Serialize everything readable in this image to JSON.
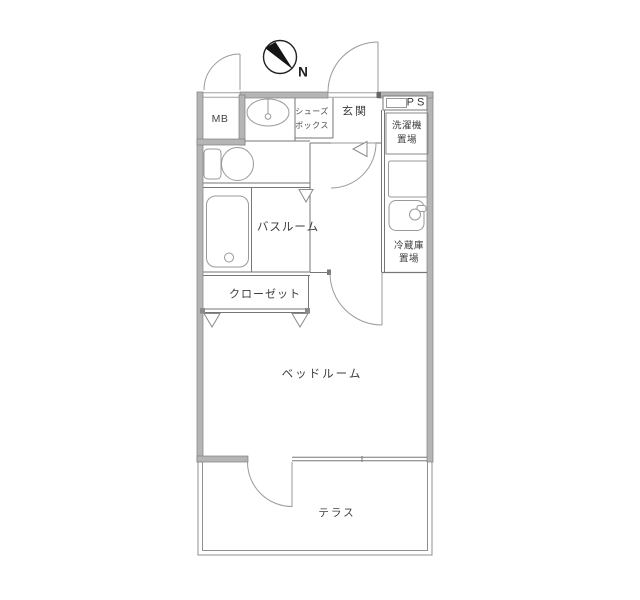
{
  "plan": {
    "compass_label": "N",
    "rooms": {
      "mb": "MB",
      "ps": "PS",
      "entrance": "玄関",
      "shoe_box_line1": "シューズ",
      "shoe_box_line2": "ボックス",
      "washer_line1": "洗濯機",
      "washer_line2": "置場",
      "fridge_line1": "冷蔵庫",
      "fridge_line2": "置場",
      "bathroom": "バスルーム",
      "closet": "クローゼット",
      "bedroom": "ベッドルーム",
      "terrace": "テラス"
    },
    "colors": {
      "wall_fill": "#b5b5b5",
      "wall_edge": "#7e7e7e",
      "thin_line": "#767676",
      "fixture_line": "#999999",
      "door_arc": "#9a9a9a",
      "text": "#3d3d3d",
      "compass_needle": "#151515"
    }
  }
}
